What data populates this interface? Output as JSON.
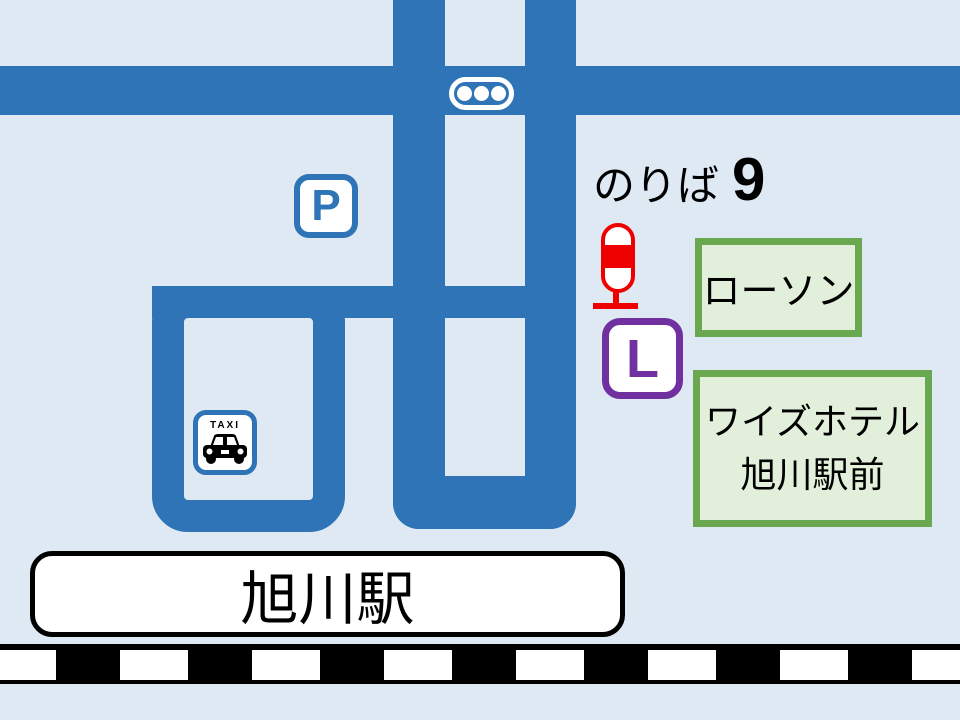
{
  "colors": {
    "bg": "#DEE9F4",
    "road": "#2E74B6",
    "white": "#FFFFFF",
    "black": "#000000",
    "red": "#EE0000",
    "purple": "#7030A0",
    "green": "#6AA84F",
    "greenfill": "#E2EFDA",
    "blue": "#2E74B6"
  },
  "map": {
    "boarding_point": {
      "prefix": "のりば",
      "number": "9"
    },
    "parking_sign": "P",
    "taxi_sign": "TAXI",
    "lawson_sign": "L",
    "lawson_label": "ローソン",
    "hotel_label_line1": "ワイズホテル",
    "hotel_label_line2": "旭川駅前",
    "station_label": "旭川駅"
  },
  "icons": {
    "traffic_signal": "three-lamp-signal",
    "parking": "parking-sign",
    "taxi": "taxi-sign",
    "bus_stop_pole": "red-busstop-pole",
    "lawson": "lawson-L-sign",
    "railway": "railway-track-ties"
  }
}
